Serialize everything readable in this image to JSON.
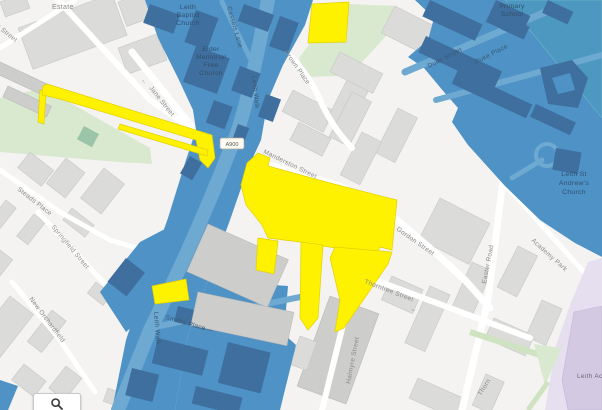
{
  "map": {
    "labels": {
      "estate": "Estate",
      "art_street_partial": "art Street",
      "jane_street": "Jane Street",
      "leith_baptist_church": [
        "Leith",
        "Baptist",
        "Church"
      ],
      "cassels_lane": "Cassels Lane",
      "elder_memorial_free_church": [
        "Elder",
        "Memorial",
        "Free",
        "Church"
      ],
      "leith_walk": "Leith Walk",
      "a900_road_ref": "A900",
      "crown_place": "Crown Place",
      "primary_school": [
        "Primary",
        "School"
      ],
      "duke_street": "Duke Street",
      "duke_place": "Duke Place",
      "manderston_street": "Manderston Street",
      "gordon_street": "Gordon Street",
      "easter_road": "Easter Road",
      "academy_park": "Academy Park",
      "leith_st_andrews_church": [
        "Leith St",
        "Andrew's",
        "Church"
      ],
      "thorntree_street": "Thorntree Street",
      "thorntree_partial": "Thorn",
      "halmyre_street": "Halmyre Street",
      "smiths_place": "Smiths Place",
      "steads_place": "Steads Place",
      "springfield_street": "Springfield Street",
      "new_orchardfield": "New Orchardfield",
      "leith_academy_partial": "Leith Ac",
      "one_way_arrow": "←"
    },
    "colors": {
      "map_bg": "#f4f3f1",
      "flood_blue": "#4e92c6",
      "flood_blue_dark": "#3f6f9e",
      "flood_blue_road": "#6ea9d2",
      "teal_tint": "#4ba3b8",
      "highlight_yellow": "#fff200",
      "building_gray": "#dbdbd9",
      "building_dark_gray": "#cdcdcb",
      "green_area": "#d9e9cf",
      "lavender_area": "#e6dff0",
      "lavender_building": "#d3c9e2",
      "road_white": "#ffffff",
      "label_gray": "#8a8a8a",
      "label_blue": "#3b5a74",
      "poi_blue": "#31506e"
    },
    "controls": {
      "search_icon": "magnifier"
    }
  }
}
